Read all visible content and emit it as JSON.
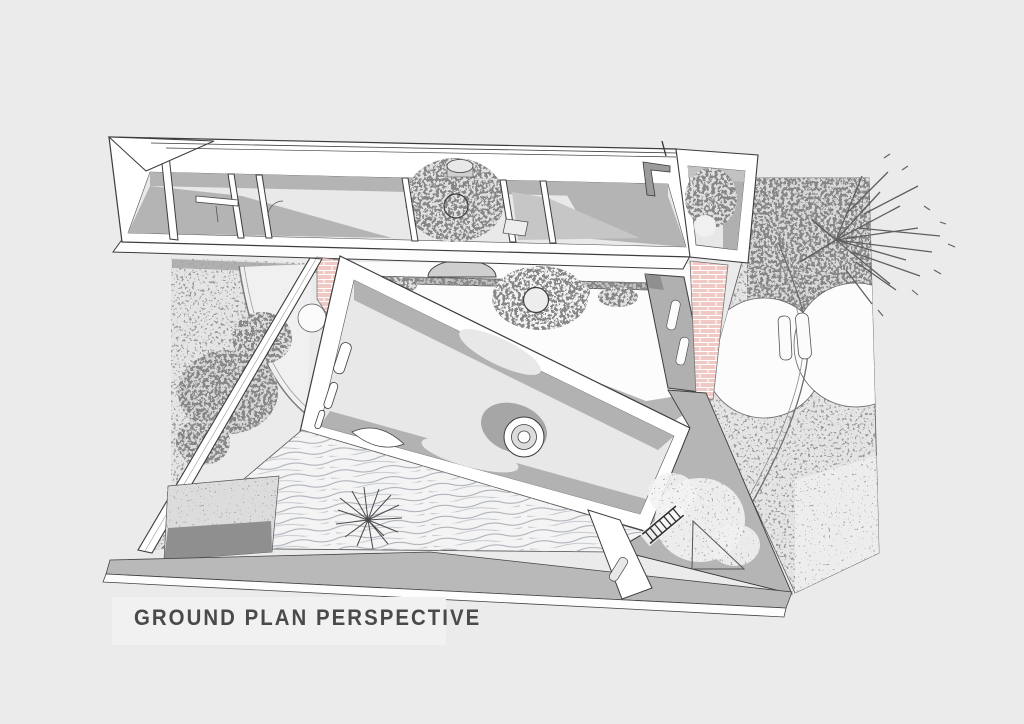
{
  "title": {
    "label": "GROUND PLAN PERSPECTIVE"
  },
  "palette": {
    "background": "#ebebeb",
    "paper_white": "#ffffff",
    "floor_gray": "#e8e8e8",
    "shadow_gray": "#b4b4b4",
    "paving_gray": "#b9b9b9",
    "dark_gray": "#8f8f8f",
    "line_ink": "#3c3c3c",
    "brick_pink": "#f0c9c4",
    "wave_gray": "#a7acb4",
    "title_text": "#4a4a4a"
  }
}
